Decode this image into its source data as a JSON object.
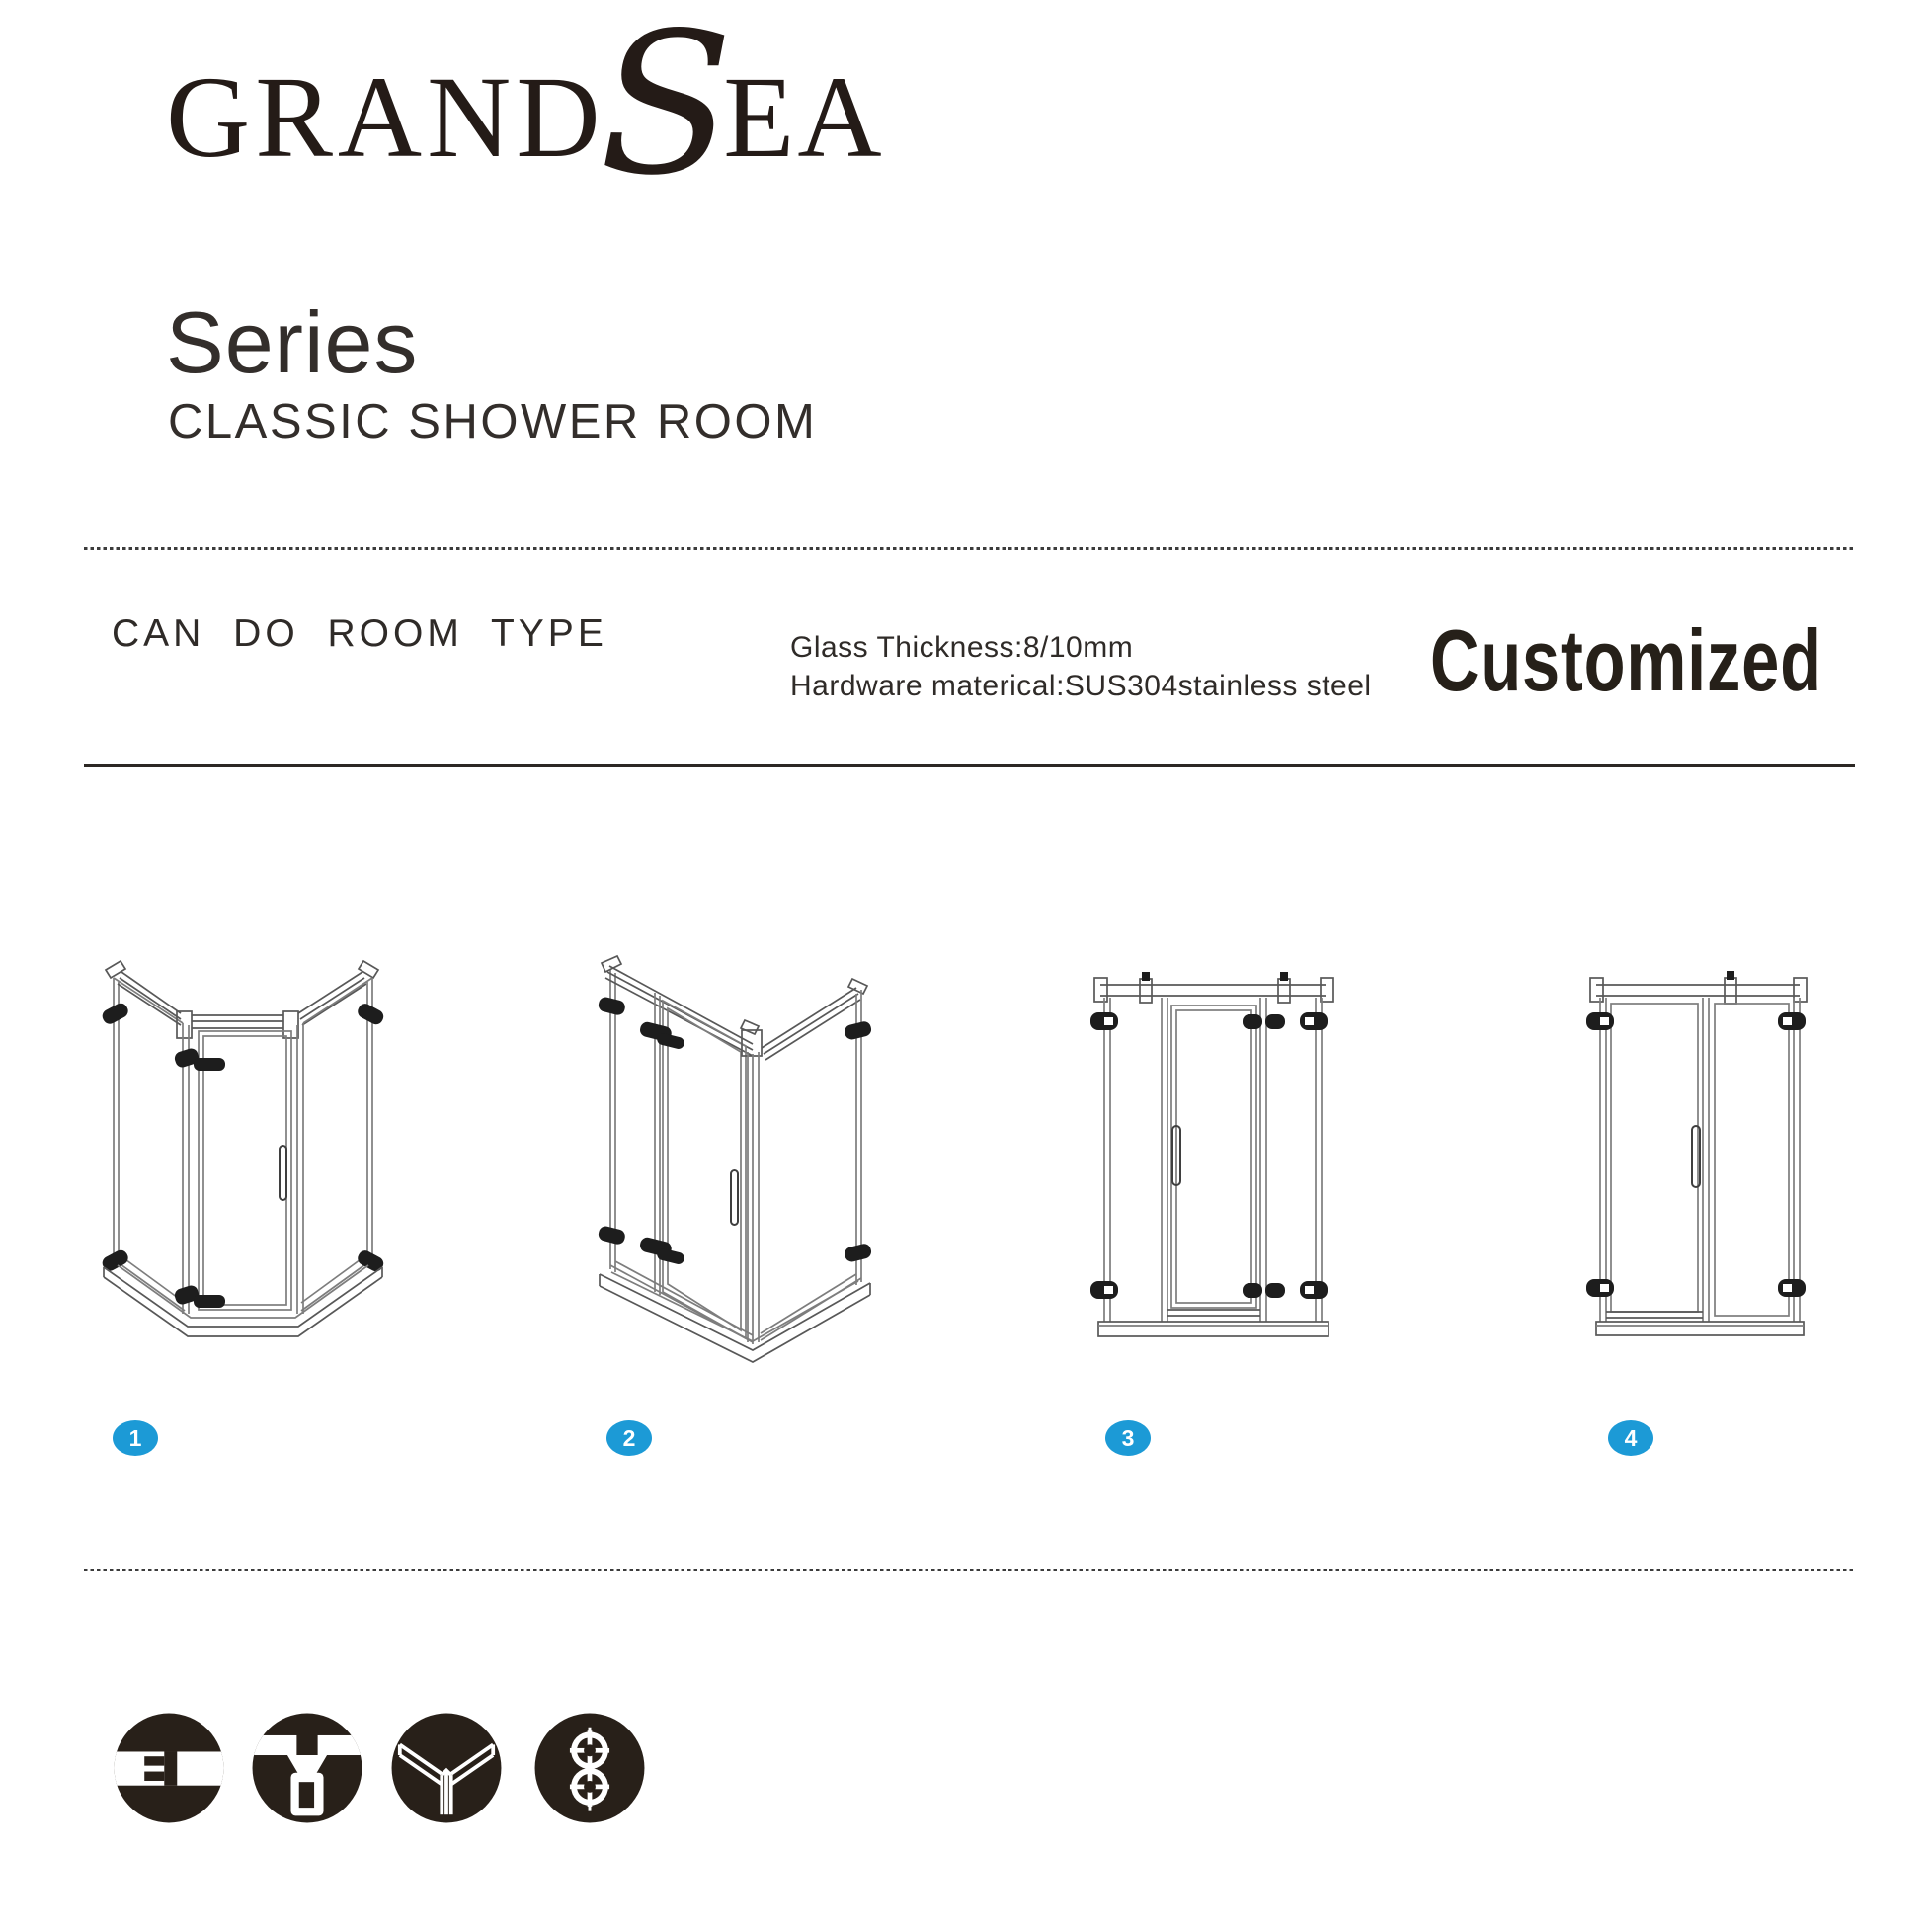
{
  "brand": {
    "logo_part1": "GRAND",
    "logo_part2": "S",
    "logo_part3": "EA"
  },
  "header": {
    "series_title": "Series",
    "series_subtitle": "CLASSIC SHOWER ROOM"
  },
  "section": {
    "label": "CAN DO ROOM TYPE",
    "spec_line1": "Glass Thickness:8/10mm",
    "spec_line2": "Hardware materical:SUS304stainless steel",
    "customized": "Customized"
  },
  "room_types": [
    {
      "number": "1",
      "name": "neo-angle diamond shower enclosure"
    },
    {
      "number": "2",
      "name": "square corner shower enclosure"
    },
    {
      "number": "3",
      "name": "inline hinged door with two fixed panels"
    },
    {
      "number": "4",
      "name": "inline hinged door with fixed panel"
    }
  ],
  "feature_icons": [
    {
      "name": "glass-connector-icon"
    },
    {
      "name": "glass-clamp-icon"
    },
    {
      "name": "folding-panel-icon"
    },
    {
      "name": "roller-wheels-icon"
    }
  ],
  "colors": {
    "accent_blue": "#1c9ad6",
    "ink": "#2d2926",
    "line_art": "#7d7d7d",
    "icon_black": "#282019"
  }
}
